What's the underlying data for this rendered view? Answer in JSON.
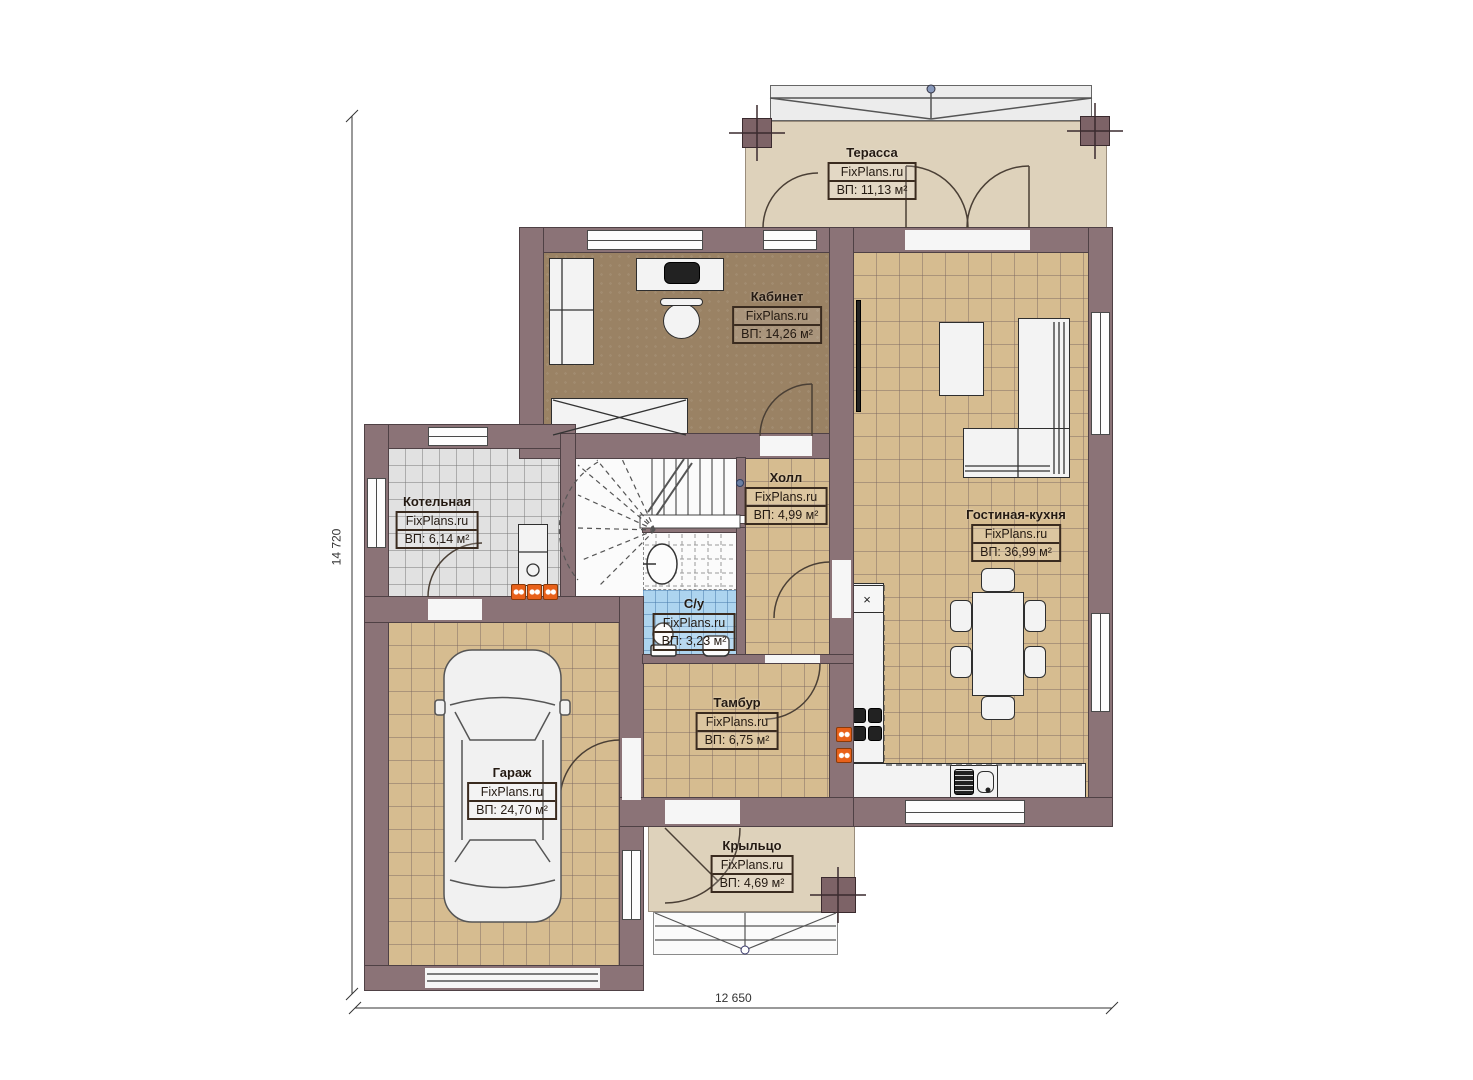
{
  "brand": "FixPlans.ru",
  "plan": {
    "width_label": "12 650",
    "height_label": "14 720"
  },
  "rooms": [
    {
      "name": "Терасса",
      "area": "ВП: 11,13 м²"
    },
    {
      "name": "Кабинет",
      "area": "ВП: 14,26 м²"
    },
    {
      "name": "Котельная",
      "area": "ВП: 6,14 м²"
    },
    {
      "name": "Холл",
      "area": "ВП: 4,99 м²"
    },
    {
      "name": "Гостиная-кухня",
      "area": "ВП: 36,99 м²"
    },
    {
      "name": "С/у",
      "area": "ВП: 3,23 м²"
    },
    {
      "name": "Тамбур",
      "area": "ВП: 6,75 м²"
    },
    {
      "name": "Гараж",
      "area": "ВП: 24,70 м²"
    },
    {
      "name": "Крыльцо",
      "area": "ВП: 4,69 м²"
    }
  ],
  "symbols": {
    "fridge_mark": "×"
  },
  "colors": {
    "wall": "#8b7377",
    "floor_tile_tan": "#d6bc90",
    "floor_office": "#9a8264",
    "floor_tile_gray": "#e1e1e1",
    "floor_tile_blue": "#add4ef",
    "floor_terrace": "#ded2bb",
    "radiator_accent": "#e8611a"
  }
}
